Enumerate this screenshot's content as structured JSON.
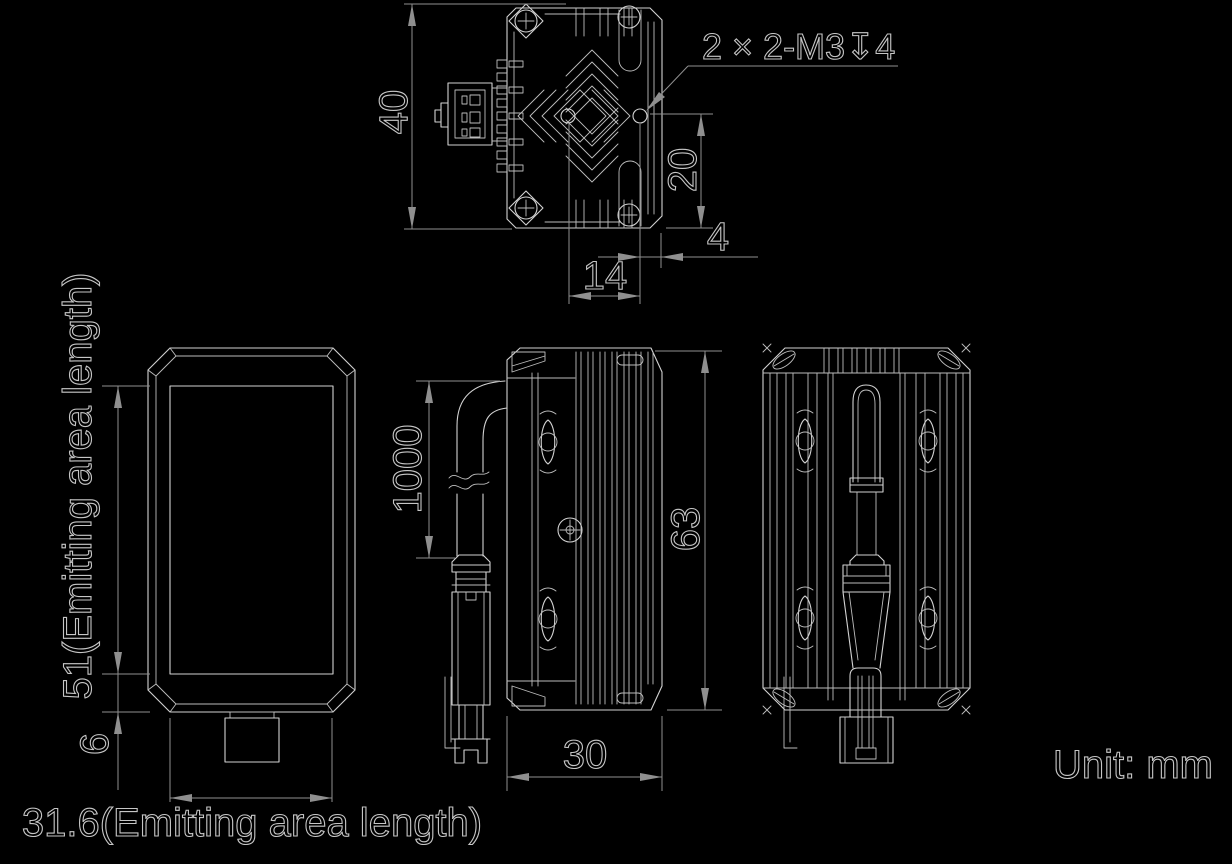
{
  "drawing": {
    "unit_note": "Unit: mm",
    "top_view": {
      "height_dim": "40",
      "thread_callout": "2 × 2-M3↧4",
      "hole_to_bottom_dim": "20",
      "hole_to_edge_dim": "4",
      "hole_pitch_dim": "14"
    },
    "front_view": {
      "emitting_length_vertical": "51(Emitting area length)",
      "bottom_offset_dim": "6",
      "emitting_length_horizontal": "31.6(Emitting area length)"
    },
    "side_view": {
      "cable_length_dim": "1000",
      "height_dim": "63",
      "width_dim": "30"
    },
    "colors": {
      "background": "#000000",
      "part_line": "#d2d2d2",
      "dimension_line": "#8f8f8f",
      "text_outline": "#c6c6c6"
    }
  }
}
